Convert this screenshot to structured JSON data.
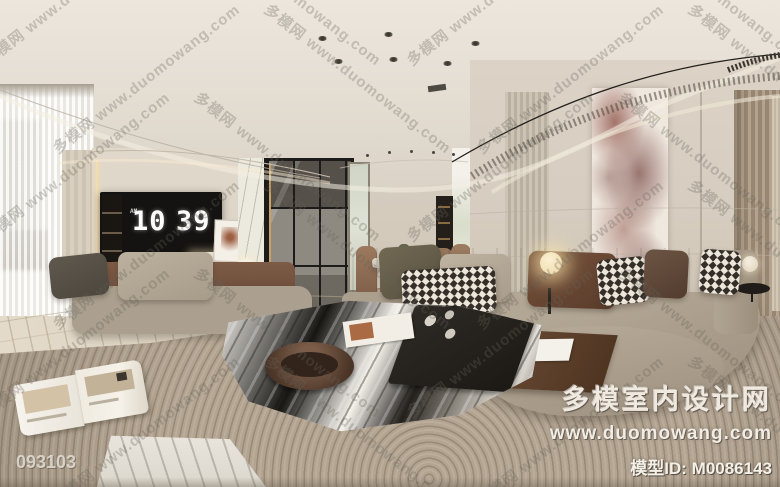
{
  "scene": {
    "description": "360-degree panorama render of a modern cream living and dining room with curved sectional sofa, ink-marble coffee table, TV wall and glass partition"
  },
  "tv": {
    "meridiem": "AM",
    "hour": "10",
    "minute": "39"
  },
  "watermark": {
    "tile_text": "多模网 www.duomowang.com"
  },
  "branding": {
    "site_name": "多模室内设计网",
    "site_url": "www.duomowang.com",
    "model_label": "模型ID:",
    "model_id": "M0086143"
  },
  "footer": {
    "image_id": "093103"
  },
  "colors": {
    "ceiling": "#e9e3da",
    "wall": "#d5ccbe",
    "rug": "#b3a491",
    "sofa": "#a89c8b",
    "led_accent": "#f0d9a8",
    "leather": "#7b5a45",
    "marble_dark": "#1d1a17",
    "wood": "#6e4f38"
  }
}
